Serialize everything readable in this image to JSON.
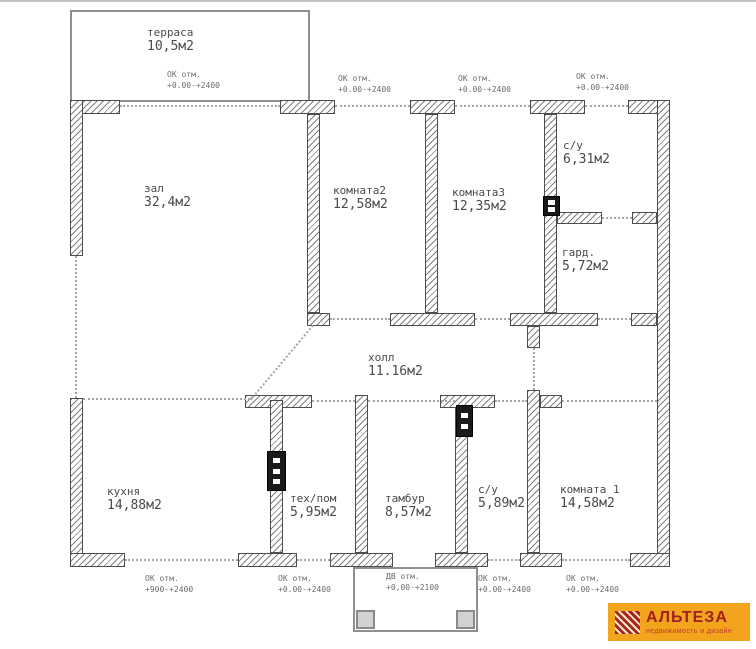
{
  "plan": {
    "rooms": [
      {
        "name": "терраса",
        "area": "10,5м2"
      },
      {
        "name": "зал",
        "area": "32,4м2"
      },
      {
        "name": "комната2",
        "area": "12,58м2"
      },
      {
        "name": "комната3",
        "area": "12,35м2"
      },
      {
        "name": "с/у",
        "area": "6,31м2"
      },
      {
        "name": "гард.",
        "area": "5,72м2"
      },
      {
        "name": "холл",
        "area": "11.16м2"
      },
      {
        "name": "кухня",
        "area": "14,88м2"
      },
      {
        "name": "тех/пом",
        "area": "5,95м2"
      },
      {
        "name": "тамбур",
        "area": "8,57м2"
      },
      {
        "name": "с/у",
        "area": "5,89м2"
      },
      {
        "name": "комната 1",
        "area": "14,58м2"
      }
    ],
    "annotations": [
      {
        "label": "ОК отм.",
        "value": "+0.00-+2400"
      },
      {
        "label": "ОК отм.",
        "value": "+0.00-+2400"
      },
      {
        "label": "ОК отм.",
        "value": "+0.00-+2400"
      },
      {
        "label": "ОК отм.",
        "value": "+0.00-+2400"
      },
      {
        "label": "ОК отм.",
        "value": "+900-+2400"
      },
      {
        "label": "ОК отм.",
        "value": "+0.00-+2400"
      },
      {
        "label": "ДВ отм.",
        "value": "+0,00-+2100"
      },
      {
        "label": "ОК отм.",
        "value": "+0.00-+2400"
      },
      {
        "label": "ОК отм.",
        "value": "+0.00-+2400"
      }
    ]
  },
  "logo": {
    "title": "АЛЬТЕЗА",
    "subtitle": "недвижимость и дизайн",
    "colors": {
      "background": "#F2A41D",
      "title": "#9E1F1F",
      "subtitle": "#C0392B",
      "icon": "#A72522"
    }
  }
}
